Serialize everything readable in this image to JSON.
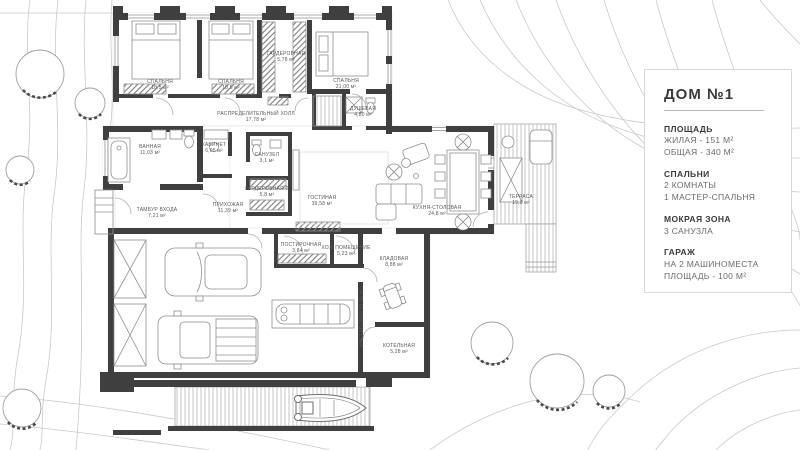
{
  "info_card": {
    "title": "ДОМ №1",
    "sections": [
      {
        "heading": "ПЛОЩАДЬ",
        "lines": [
          "ЖИЛАЯ - 151 М²",
          "ОБЩАЯ - 340 М²"
        ]
      },
      {
        "heading": "СПАЛЬНИ",
        "lines": [
          "2 КОМНАТЫ",
          "1 МАСТЕР-СПАЛЬНЯ"
        ]
      },
      {
        "heading": "МОКРАЯ ЗОНА",
        "lines": [
          "3 САНУЗЛА"
        ]
      },
      {
        "heading": "ГАРАЖ",
        "lines": [
          "НА 2 МАШИНОМЕСТА",
          "ПЛОЩАДЬ - 100 М²"
        ]
      }
    ]
  },
  "plan": {
    "rooms": [
      {
        "label": "СПАЛЬНЯ\n18,5 м²"
      },
      {
        "label": "СПАЛЬНЯ\n18,5 м²"
      },
      {
        "label": "ГАРДЕРОБНАЯ\n5,78 м²"
      },
      {
        "label": "СПАЛЬНЯ\n21,00 м²"
      },
      {
        "label": "ДУШЕВАЯ\n4,80 м²"
      },
      {
        "label": "РАСПРЕДЕЛИТЕЛЬНЫЙ ХОЛЛ\n17,78 м²"
      },
      {
        "label": "ВАННАЯ\n11,03 м²"
      },
      {
        "label": "КАБИНЕТ\n6,05 м²"
      },
      {
        "label": "САНУЗЕЛ\n3,1 м²"
      },
      {
        "label": "ГАРДЕРОБНАЯ-2\n5,8 м²"
      },
      {
        "label": "ПРИХОЖАЯ\n11,39 м²"
      },
      {
        "label": "ТАМБУР ВХОДА\n7,21 м²"
      },
      {
        "label": "ГОСТИНАЯ\n39,58 м²"
      },
      {
        "label": "КУХНЯ-СТОЛОВАЯ\n24,8 м²"
      },
      {
        "label": "ТЕРРАСА\n19,0 м²"
      },
      {
        "label": "ПОСТИРОЧНАЯ\n3,84 м²"
      },
      {
        "label": "ХОЗ. ПОМЕЩЕНИЕ\n5,23 м²"
      },
      {
        "label": "КЛАДОВАЯ\n8,88 м²"
      },
      {
        "label": "КОТЕЛЬНАЯ\n5,28 м²"
      },
      {
        "label": "МАСТЕРСКАЯ 28,58 м²"
      }
    ]
  },
  "colors": {
    "wall": "#3f3f3f",
    "furniture_line": "#8f8f8f",
    "contour_line": "#c9c9c9",
    "label_text": "#5a5a5a"
  }
}
